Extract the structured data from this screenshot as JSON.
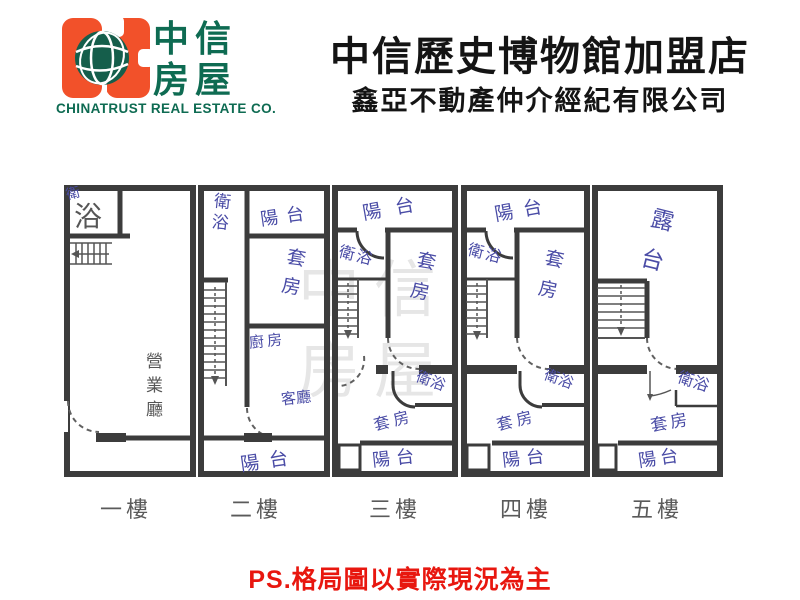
{
  "header": {
    "title": "中信歷史博物館加盟店",
    "subtitle": "鑫亞不動產仲介經紀有限公司",
    "logo": {
      "brand_line1": "中信",
      "brand_line2": "房屋",
      "brand_en": "CHINATRUST REAL ESTATE CO.",
      "colors": {
        "orange": "#F2512A",
        "green": "#0E6B52"
      }
    }
  },
  "floorplan": {
    "colors": {
      "wall": "#3C3C3C",
      "ink": "#4A4CA6",
      "print_gray": "#565656"
    },
    "watermark": "中信房屋",
    "floors": {
      "f1": {
        "label": "一樓",
        "bath_hand": "衛",
        "bath": "浴",
        "hall": "營業廳"
      },
      "f2": {
        "label": "二樓",
        "bath": "衛浴",
        "balcony_top": "陽台",
        "suite": "套房",
        "kitchen": "廚房",
        "living": "客廳",
        "balcony_bottom": "陽台"
      },
      "f3": {
        "label": "三樓",
        "balcony_top": "陽台",
        "bath_top": "衛浴",
        "suite_top": "套房",
        "bath_mid": "衛浴",
        "suite_bottom": "套房",
        "balcony_bottom": "陽台"
      },
      "f4": {
        "label": "四樓",
        "balcony_top": "陽台",
        "bath_top": "衛浴",
        "suite_top": "套房",
        "bath_mid": "衛浴",
        "suite_bottom": "套房",
        "balcony_bottom": "陽台"
      },
      "f5": {
        "label": "五樓",
        "terrace": "露台",
        "bath": "衛浴",
        "suite": "套房",
        "balcony": "陽台"
      }
    }
  },
  "footer": {
    "note": "PS.格局圖以實際現況為主"
  }
}
